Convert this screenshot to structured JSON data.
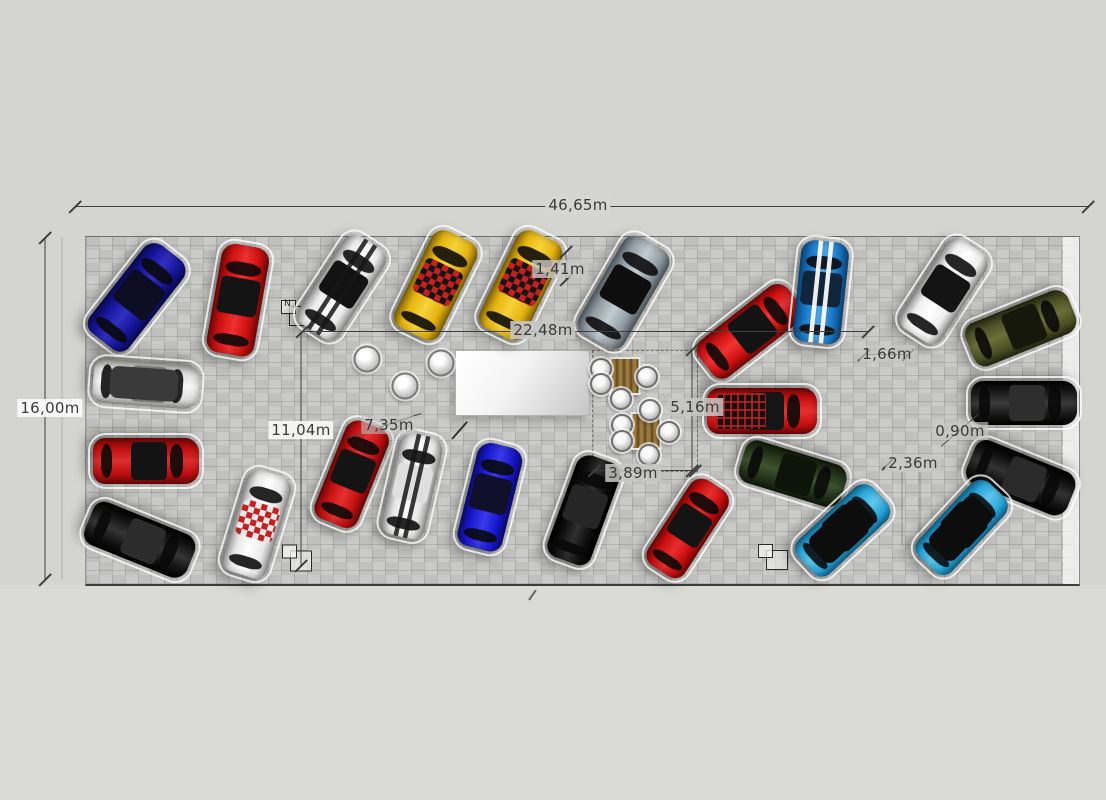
{
  "scene": {
    "description": "top-down CAD floor plan of a car showroom with dimension annotations",
    "background": "#d4d4d0",
    "floor_fill": "#c7c7c5",
    "floor_rect": {
      "x": 85,
      "y": 236,
      "w": 993,
      "h": 347
    }
  },
  "chart_data": {
    "type": "table",
    "title": "showroom dimensions",
    "dimensions_m": {
      "total_width": "46,65m",
      "total_depth": "16,00m",
      "interior_span": "22,48m",
      "aisle_a": "11,04m",
      "aisle_b": "7,35m",
      "lounge_depth": "5,16m",
      "lounge_width": "3,89m",
      "gap_small_1": "1,41m",
      "gap_small_2": "1,66m",
      "gap_small_3": "0,90m",
      "gap_small_4": "2,36m"
    }
  },
  "annotations": {
    "labels": [
      {
        "text": "46,65m",
        "x": 578,
        "y": 205,
        "bg": "#d6d6d2"
      },
      {
        "text": "16,00m",
        "x": 50,
        "y": 408,
        "bg": "rgba(252,252,252,0.92)"
      },
      {
        "text": "22,48m",
        "x": 543,
        "y": 330,
        "bg": "rgba(199,199,197,0.9)"
      },
      {
        "text": "1,41m",
        "x": 560,
        "y": 269,
        "bg": "rgba(199,199,197,0.8)"
      },
      {
        "text": "11,04m",
        "x": 301,
        "y": 430,
        "bg": "rgba(250,250,250,0.88)"
      },
      {
        "text": "7,35m",
        "x": 389,
        "y": 425,
        "bg": "rgba(199,199,197,0.55)"
      },
      {
        "text": "5,16m",
        "x": 695,
        "y": 407,
        "bg": "rgba(199,199,197,0.85)"
      },
      {
        "text": "3,89m",
        "x": 633,
        "y": 473,
        "bg": "rgba(199,199,197,0.85)"
      },
      {
        "text": "1,66m",
        "x": 887,
        "y": 354,
        "bg": "rgba(199,199,197,0.65)"
      },
      {
        "text": "0,90m",
        "x": 960,
        "y": 431,
        "bg": "rgba(199,199,197,0.65)"
      },
      {
        "text": "2,36m",
        "x": 913,
        "y": 463,
        "bg": "rgba(199,199,197,0.65)"
      }
    ],
    "lines": [
      {
        "x1": 75,
        "y1": 206,
        "x2": 1088,
        "y2": 206
      },
      {
        "x1": 45,
        "y1": 237,
        "x2": 45,
        "y2": 579
      },
      {
        "x1": 302,
        "y1": 331,
        "x2": 868,
        "y2": 331
      },
      {
        "x1": 301,
        "y1": 331,
        "x2": 301,
        "y2": 565
      },
      {
        "x1": 566,
        "y1": 251,
        "x2": 566,
        "y2": 279
      },
      {
        "x1": 692,
        "y1": 349,
        "x2": 692,
        "y2": 470
      },
      {
        "x1": 594,
        "y1": 470,
        "x2": 695,
        "y2": 470
      },
      {
        "x1": 864,
        "y1": 354,
        "x2": 910,
        "y2": 354,
        "c": "#555555"
      },
      {
        "x1": 62,
        "y1": 237,
        "x2": 62,
        "y2": 579,
        "c": "rgba(130,130,130,0.45)"
      },
      {
        "x1": 349,
        "y1": 437,
        "x2": 421,
        "y2": 413,
        "c": "#4a4a4a"
      },
      {
        "x1": 941,
        "y1": 446,
        "x2": 977,
        "y2": 415,
        "c": "#4a4a4a"
      },
      {
        "x1": 902,
        "y1": 472,
        "x2": 902,
        "y2": 545,
        "c": "rgba(90,90,90,0.5)"
      },
      {
        "x1": 920,
        "y1": 472,
        "x2": 920,
        "y2": 545,
        "c": "rgba(90,90,90,0.5)"
      },
      {
        "x1": 452,
        "y1": 438,
        "x2": 467,
        "y2": 421,
        "w": 2,
        "c": "#333333"
      },
      {
        "x1": 529,
        "y1": 599,
        "x2": 536,
        "y2": 589,
        "w": 2,
        "c": "#666666"
      }
    ],
    "ticks": [
      {
        "x": 75,
        "y": 206
      },
      {
        "x": 1088,
        "y": 206
      },
      {
        "x": 45,
        "y": 237
      },
      {
        "x": 45,
        "y": 579
      },
      {
        "x": 302,
        "y": 331
      },
      {
        "x": 868,
        "y": 331
      },
      {
        "x": 301,
        "y": 565
      },
      {
        "x": 566,
        "y": 251
      },
      {
        "x": 566,
        "y": 279
      },
      {
        "x": 692,
        "y": 349
      },
      {
        "x": 692,
        "y": 470
      },
      {
        "x": 594,
        "y": 470
      },
      {
        "x": 695,
        "y": 470
      },
      {
        "x": 864,
        "y": 354
      },
      {
        "x": 908,
        "y": 354
      },
      {
        "x": 888,
        "y": 463
      }
    ]
  },
  "cars": [
    {
      "name": "dark-blue-sedan-1",
      "x": 137,
      "y": 297,
      "w": 50,
      "l": 112,
      "rot": 38,
      "body": "#15159b",
      "edge": "#0a0a55",
      "hi": "#3030c0",
      "roof": "#0c0c22",
      "detail": "none"
    },
    {
      "name": "red-sedan-2",
      "x": 238,
      "y": 300,
      "w": 48,
      "l": 110,
      "rot": 10,
      "body": "#cf1111",
      "edge": "#7a0808",
      "hi": "#ee3030",
      "roof": "#141414",
      "detail": "none"
    },
    {
      "name": "white-muscle-3",
      "x": 342,
      "y": 287,
      "w": 48,
      "l": 106,
      "rot": 33,
      "body": "#ebebeb",
      "edge": "#9a9a9a",
      "hi": "#ffffff",
      "roof": "#121212",
      "detail": "stripesBlack"
    },
    {
      "name": "yellow-taxi-4",
      "x": 436,
      "y": 285,
      "w": 50,
      "l": 108,
      "rot": 26,
      "body": "#e6b511",
      "edge": "#8a6a08",
      "hi": "#f7d23a",
      "roof": "#151515",
      "detail": "taxiChecker"
    },
    {
      "name": "yellow-taxi-5",
      "x": 521,
      "y": 285,
      "w": 50,
      "l": 108,
      "rot": 26,
      "body": "#e6b511",
      "edge": "#8a6a08",
      "hi": "#f7d23a",
      "roof": "#151515",
      "detail": "taxiChecker"
    },
    {
      "name": "silver-suv-6",
      "x": 624,
      "y": 292,
      "w": 52,
      "l": 112,
      "rot": 30,
      "body": "#95a0a6",
      "edge": "#566066",
      "hi": "#c2ccd1",
      "roof": "#0e0e0e",
      "detail": "none"
    },
    {
      "name": "red-coupe-7",
      "x": 750,
      "y": 331,
      "w": 46,
      "l": 112,
      "rot": 52,
      "body": "#d01111",
      "edge": "#780909",
      "hi": "#ef3434",
      "roof": "#131313",
      "detail": "none"
    },
    {
      "name": "blue-stripe-8",
      "x": 821,
      "y": 292,
      "w": 48,
      "l": 102,
      "rot": 6,
      "body": "#1a7ac9",
      "edge": "#0c4a80",
      "hi": "#4da2e4",
      "roof": "#10253a",
      "detail": "stripesWhite"
    },
    {
      "name": "white-pickup-9",
      "x": 944,
      "y": 291,
      "w": 48,
      "l": 106,
      "rot": 33,
      "body": "#efefef",
      "edge": "#9a9a9a",
      "hi": "#ffffff",
      "roof": "#141414",
      "detail": "none"
    },
    {
      "name": "olive-suv-10",
      "x": 1021,
      "y": 328,
      "w": 46,
      "l": 110,
      "rot": 68,
      "body": "#4c5126",
      "edge": "#262a10",
      "hi": "#6a7038",
      "roof": "#15180a",
      "detail": "none"
    },
    {
      "name": "black-suv-11",
      "x": 1024,
      "y": 403,
      "w": 44,
      "l": 106,
      "rot": 90,
      "body": "#161616",
      "edge": "#000000",
      "hi": "#3a3a3a",
      "roof": "#2e2e2e",
      "detail": "none"
    },
    {
      "name": "black-suv-12",
      "x": 1021,
      "y": 478,
      "w": 46,
      "l": 108,
      "rot": 112,
      "body": "#101010",
      "edge": "#000000",
      "hi": "#333333",
      "roof": "#2a2a2a",
      "detail": "none"
    },
    {
      "name": "red-pickup-13",
      "x": 762,
      "y": 411,
      "w": 46,
      "l": 110,
      "rot": 90,
      "body": "#c91010",
      "edge": "#6f0707",
      "hi": "#e83030",
      "roof": "#151515",
      "detail": "cargoGrid"
    },
    {
      "name": "dark-green-14",
      "x": 793,
      "y": 474,
      "w": 44,
      "l": 106,
      "rot": 107,
      "body": "#233319",
      "edge": "#101a0a",
      "hi": "#3d5430",
      "roof": "#0d140a",
      "detail": "none"
    },
    {
      "name": "cyan-convertible-15",
      "x": 843,
      "y": 530,
      "w": 46,
      "l": 102,
      "rot": 47,
      "body": "#2aa9dc",
      "edge": "#116a96",
      "hi": "#5fc6ec",
      "roof": "#0d0d0d",
      "detail": "convertible",
      "interior": "#0d0d0d"
    },
    {
      "name": "cyan-convertible-16",
      "x": 962,
      "y": 527,
      "w": 46,
      "l": 102,
      "rot": 43,
      "body": "#2aa9dc",
      "edge": "#116a96",
      "hi": "#5fc6ec",
      "roof": "#0d0d0d",
      "detail": "convertible",
      "interior": "#0d0d0d"
    },
    {
      "name": "white-roadster-17",
      "x": 146,
      "y": 384,
      "w": 44,
      "l": 106,
      "rot": 94,
      "body": "#dedede",
      "edge": "#9c9c9c",
      "hi": "#f8f8f8",
      "roof": "#777777",
      "detail": "convertible",
      "interior": "#3a3a3a"
    },
    {
      "name": "red-sedan-18",
      "x": 146,
      "y": 461,
      "w": 46,
      "l": 106,
      "rot": 90,
      "body": "#bb0f0f",
      "edge": "#6d0606",
      "hi": "#dd2e2e",
      "roof": "#131313",
      "detail": "none"
    },
    {
      "name": "black-sedan-19",
      "x": 140,
      "y": 540,
      "w": 46,
      "l": 110,
      "rot": 112,
      "body": "#121212",
      "edge": "#000000",
      "hi": "#353535",
      "roof": "#2c2c2c",
      "detail": "none"
    },
    {
      "name": "race-checker-20",
      "x": 257,
      "y": 524,
      "w": 46,
      "l": 106,
      "rot": 17,
      "body": "#e9e9e9",
      "edge": "#9f9f9f",
      "hi": "#ffffff",
      "roof": "#e8e8e8",
      "detail": "raceChecker"
    },
    {
      "name": "red-sedan-21",
      "x": 352,
      "y": 474,
      "w": 46,
      "l": 106,
      "rot": 22,
      "body": "#c51111",
      "edge": "#730808",
      "hi": "#e53030",
      "roof": "#141414",
      "detail": "none"
    },
    {
      "name": "white-stripe-22",
      "x": 412,
      "y": 486,
      "w": 44,
      "l": 104,
      "rot": 13,
      "body": "#e7e7e7",
      "edge": "#9d9d9d",
      "hi": "#ffffff",
      "roof": "#dfdfdf",
      "detail": "stripesBlack"
    },
    {
      "name": "blue-sedan-23",
      "x": 490,
      "y": 497,
      "w": 46,
      "l": 106,
      "rot": 14,
      "body": "#1818cf",
      "edge": "#0b0b77",
      "hi": "#3a3aea",
      "roof": "#10102a",
      "detail": "none"
    },
    {
      "name": "black-sedan-24",
      "x": 584,
      "y": 510,
      "w": 46,
      "l": 108,
      "rot": 20,
      "body": "#0e0e0e",
      "edge": "#000000",
      "hi": "#303030",
      "roof": "#262626",
      "detail": "none"
    },
    {
      "name": "red-coupe-25",
      "x": 688,
      "y": 528,
      "w": 44,
      "l": 102,
      "rot": 33,
      "body": "#c90e0e",
      "edge": "#770707",
      "hi": "#e72e2e",
      "roof": "#141414",
      "detail": "none"
    }
  ],
  "furniture": {
    "desk": {
      "x": 455,
      "y": 350,
      "w": 133,
      "h": 64
    },
    "dashed_rect": {
      "x": 592,
      "y": 350,
      "w": 104,
      "h": 120
    },
    "stools": [
      {
        "x": 367,
        "y": 359
      },
      {
        "x": 441,
        "y": 363
      },
      {
        "x": 405,
        "y": 386
      }
    ],
    "tables": [
      {
        "x": 625,
        "y": 376
      },
      {
        "x": 646,
        "y": 431
      }
    ],
    "chairs": [
      {
        "x": 601,
        "y": 369
      },
      {
        "x": 601,
        "y": 384
      },
      {
        "x": 647,
        "y": 377
      },
      {
        "x": 621,
        "y": 399
      },
      {
        "x": 650,
        "y": 410
      },
      {
        "x": 622,
        "y": 425
      },
      {
        "x": 622,
        "y": 441
      },
      {
        "x": 669,
        "y": 432
      },
      {
        "x": 649,
        "y": 455
      }
    ]
  },
  "symbols": [
    {
      "x": 296,
      "y": 313,
      "w": 30,
      "h": 26,
      "tag": "N"
    },
    {
      "x": 789,
      "y": 311,
      "w": 26,
      "h": 24,
      "tag": ""
    },
    {
      "x": 297,
      "y": 558,
      "w": 30,
      "h": 27,
      "tag": ""
    },
    {
      "x": 773,
      "y": 557,
      "w": 30,
      "h": 26,
      "tag": ""
    }
  ]
}
